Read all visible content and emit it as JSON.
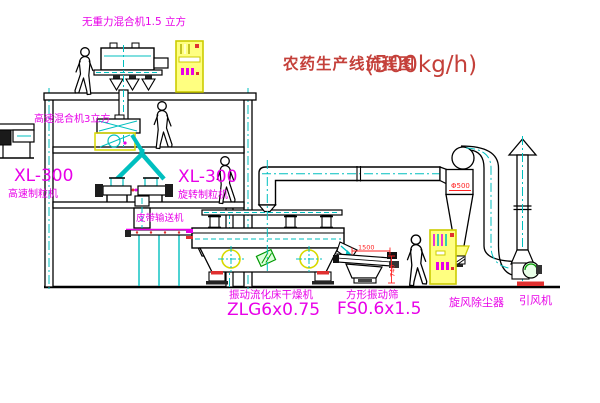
{
  "title": {
    "main": "农药生产线流程图",
    "capacity": "(500kg/h)"
  },
  "equipment_labels": {
    "gravity_free_mixer": "无重力混合机1.5 立方",
    "high_speed_mixer": "高速混合机3立方",
    "granulator_left_model": "XL-300",
    "granulator_left_name": "高速制粒机",
    "granulator_right_model": "XL-300",
    "granulator_right_name": "旋转制粒机",
    "belt_conveyor": "皮带输送机",
    "fluid_bed_dryer_name": "振动流化床干燥机",
    "fluid_bed_dryer_model": "ZLG6x0.75",
    "square_sieve_name": "方形振动筛",
    "square_sieve_model": "FS0.6x1.5",
    "cyclone_dust_collector": "旋风除尘器",
    "induced_draft_fan": "引风机"
  },
  "dimensions": {
    "cyclone_diameter": "Φ500",
    "sieve_length": "1500",
    "sieve_height": "740"
  },
  "colors": {
    "line_black": "#000000",
    "centerline_cyan": "#00bfbf",
    "label_magenta": "#e800e8",
    "title_red": "#c4403a",
    "dimension_red": "#ff2222",
    "cabinet_yellow": "#ffff80",
    "accent_green": "#009900"
  }
}
